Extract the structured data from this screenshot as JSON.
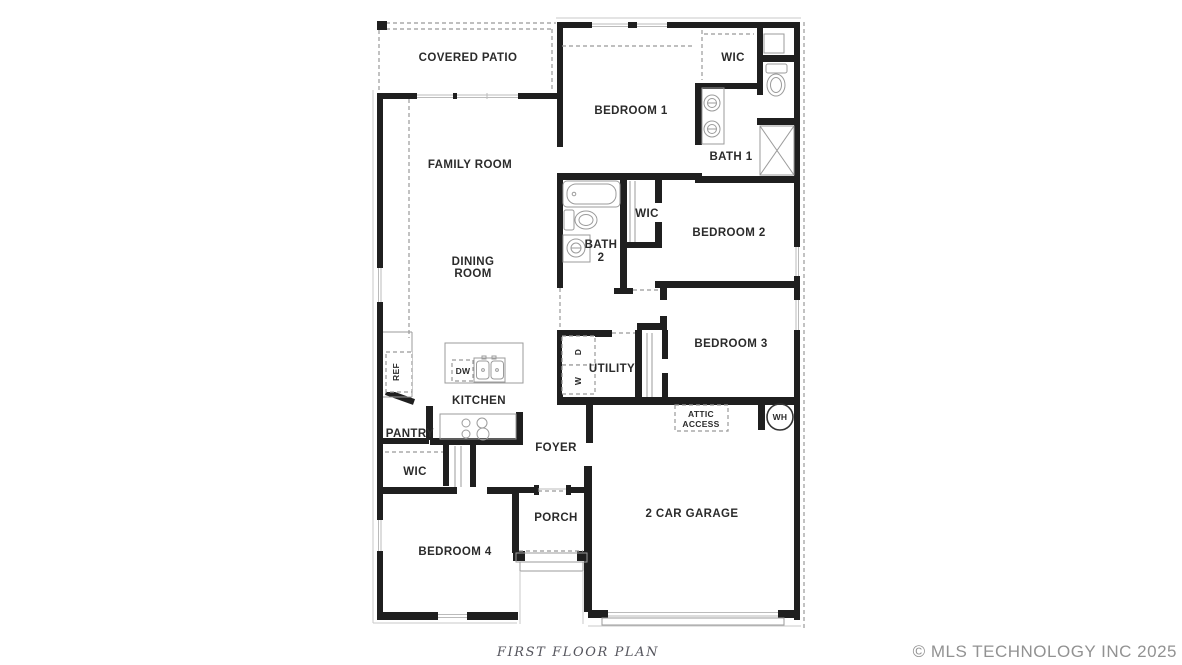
{
  "colors": {
    "background": "#ffffff",
    "wall": "#1f1f1f",
    "label": "#2b2b2b",
    "fixture": "#9b9b9b",
    "dash": "#999999",
    "window_line": "#bbbbbb",
    "footer": "#55555d",
    "watermark": "#929292"
  },
  "plan": {
    "footer": {
      "title": "FIRST FLOOR PLAN",
      "watermark": "© MLS TECHNOLOGY INC 2025"
    },
    "rooms": [
      {
        "id": "covered-patio",
        "label": "COVERED PATIO"
      },
      {
        "id": "bedroom-1",
        "label": "BEDROOM 1"
      },
      {
        "id": "wic-1",
        "label": "WIC"
      },
      {
        "id": "bath-1",
        "label": "BATH 1"
      },
      {
        "id": "family-room",
        "label": "FAMILY ROOM"
      },
      {
        "id": "bath-2",
        "label": "BATH",
        "label2": "2"
      },
      {
        "id": "wic-2",
        "label": "WIC"
      },
      {
        "id": "bedroom-2",
        "label": "BEDROOM 2"
      },
      {
        "id": "dining-room",
        "label": "DINING",
        "label2": "ROOM"
      },
      {
        "id": "bedroom-3",
        "label": "BEDROOM 3"
      },
      {
        "id": "utility",
        "label": "UTILITY"
      },
      {
        "id": "kitchen",
        "label": "KITCHEN"
      },
      {
        "id": "pantry",
        "label": "PANTRY"
      },
      {
        "id": "foyer",
        "label": "FOYER"
      },
      {
        "id": "wic-3",
        "label": "WIC"
      },
      {
        "id": "attic-access",
        "label": "ATTIC",
        "label2": "ACCESS"
      },
      {
        "id": "water-heater",
        "label": "WH"
      },
      {
        "id": "garage",
        "label": "2 CAR GARAGE"
      },
      {
        "id": "porch",
        "label": "PORCH"
      },
      {
        "id": "bedroom-4",
        "label": "BEDROOM 4"
      }
    ],
    "appliances": {
      "dishwasher": "DW",
      "refrigerator": "REF",
      "dryer": "D",
      "washer": "W"
    }
  }
}
